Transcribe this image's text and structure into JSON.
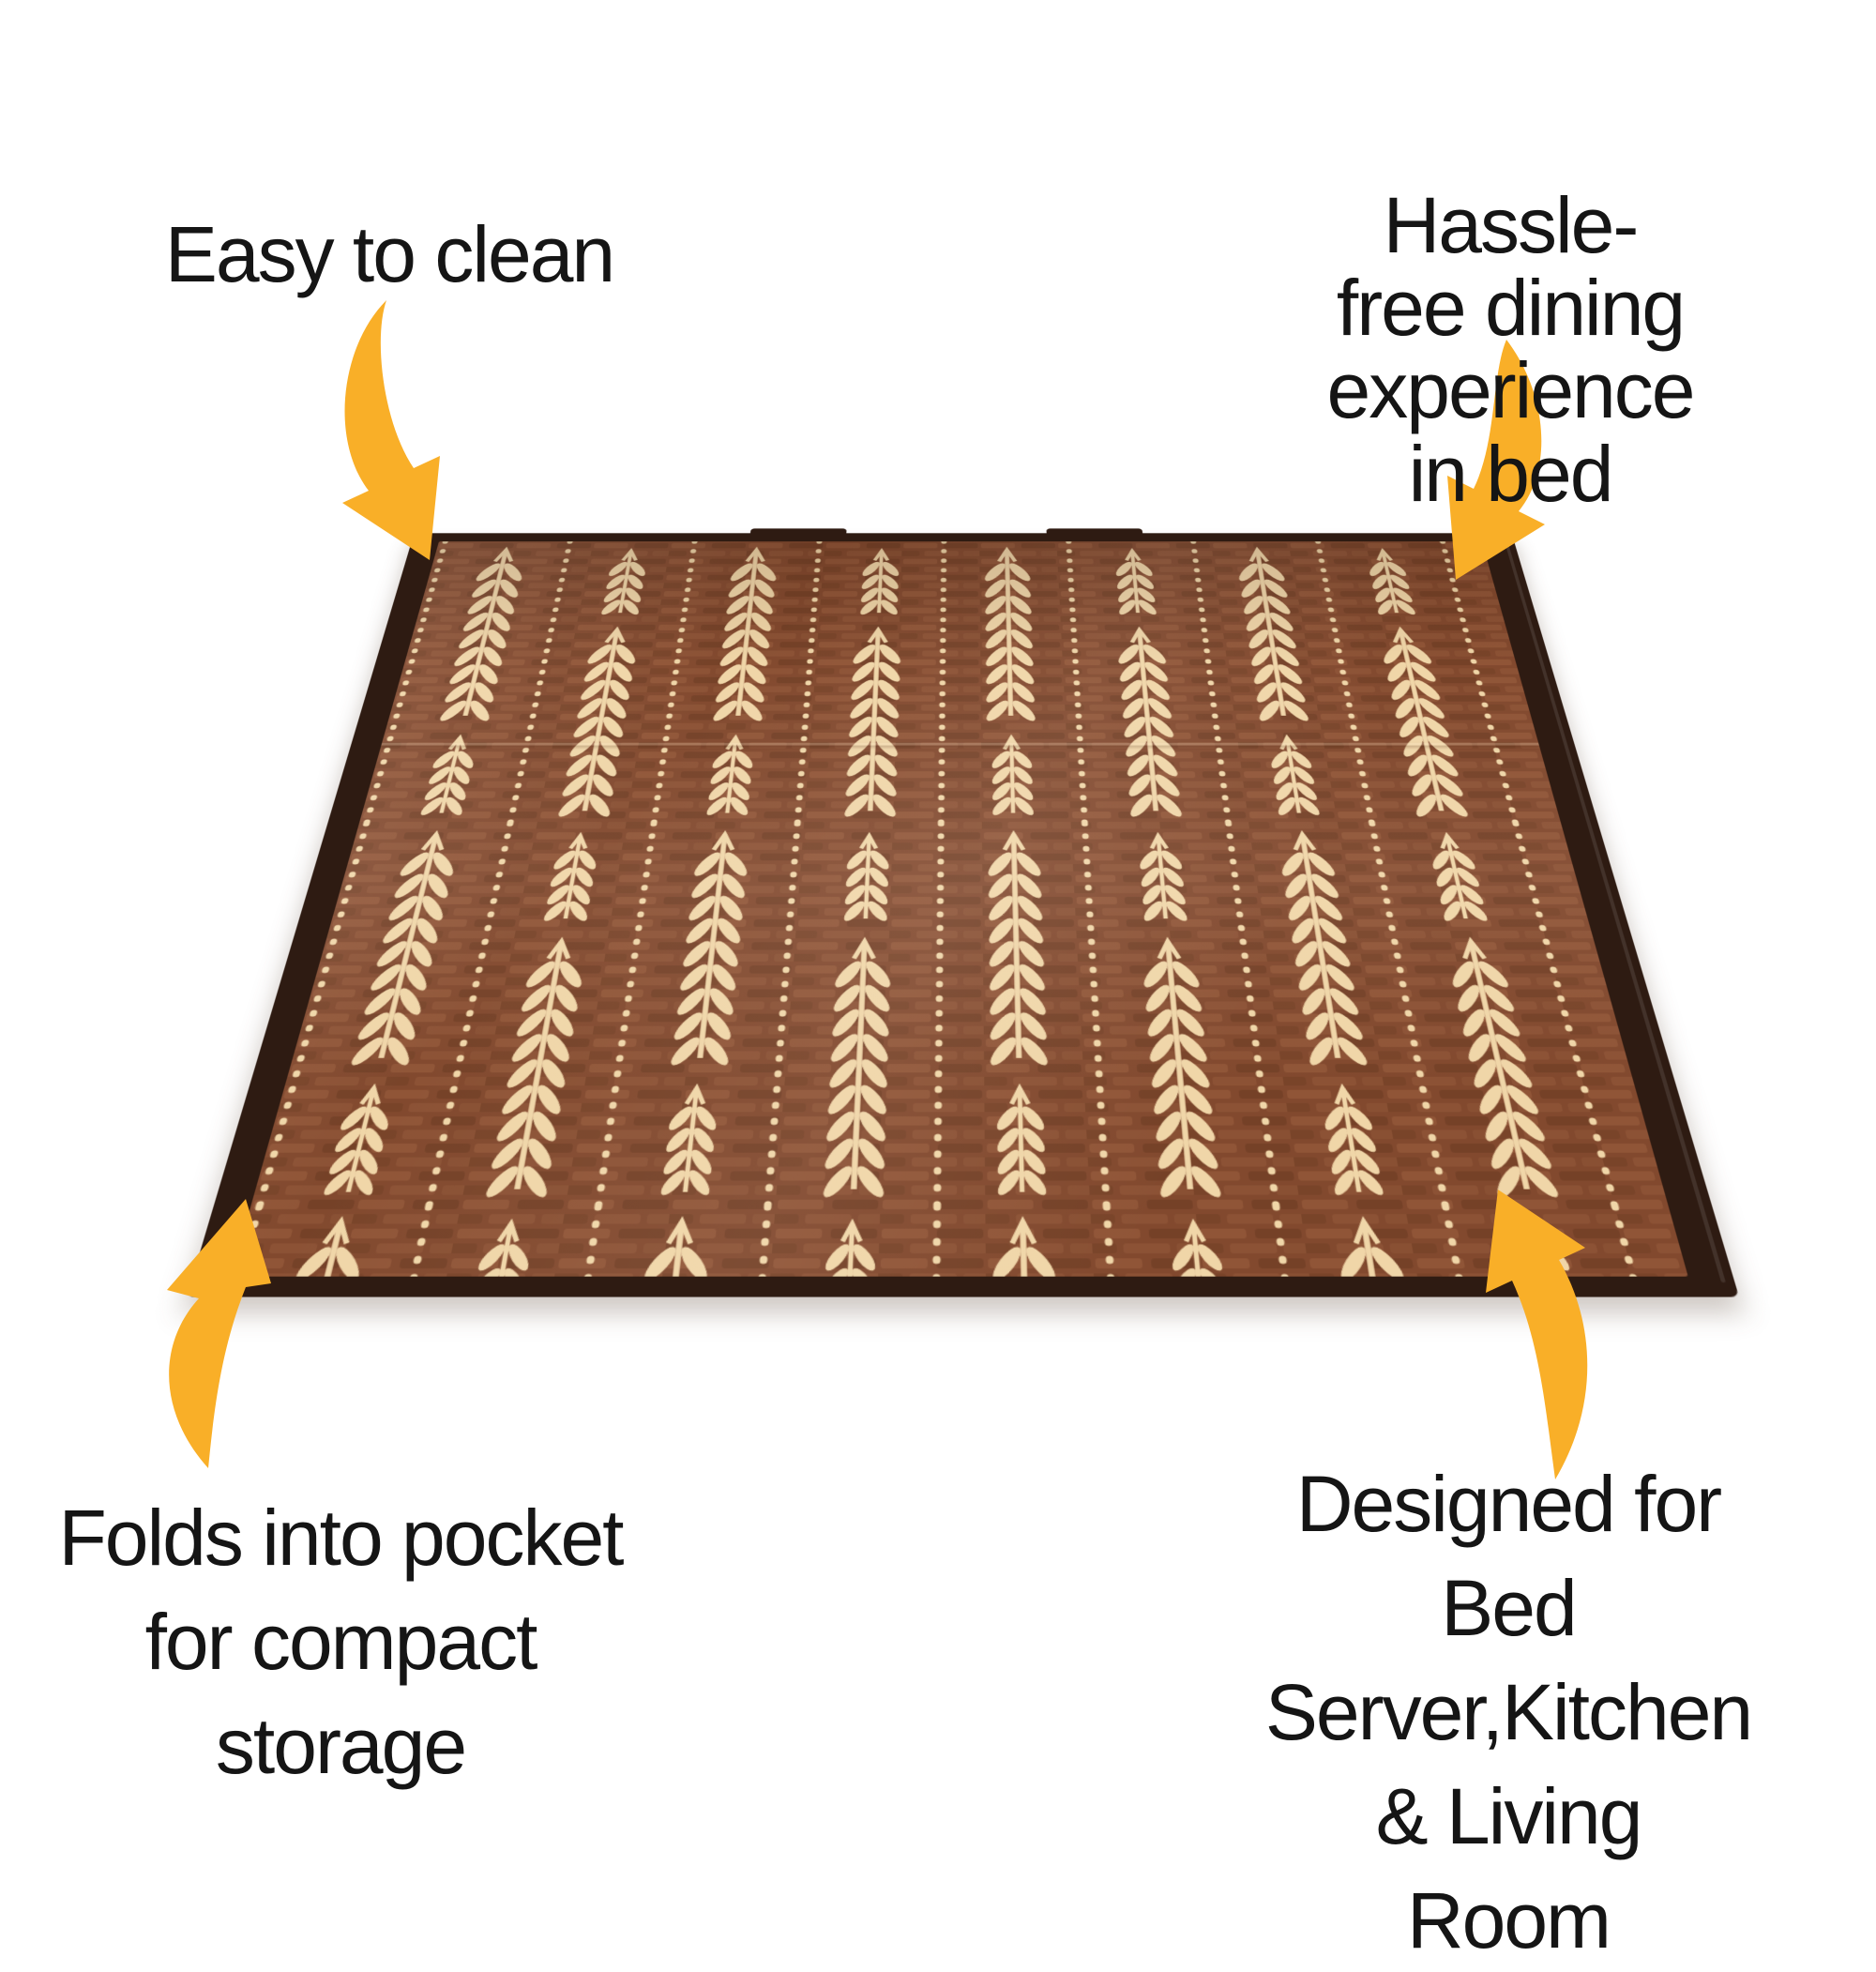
{
  "page": {
    "background": "#FFFFFF",
    "text_color": "#151515"
  },
  "callouts": {
    "top_left": "Easy to clean",
    "top_right": "Hassle-free dining\nexperience in bed",
    "bottom_left": "Folds into pocket\nfor compact\nstorage",
    "bottom_right": "Designed for\nBed Server,Kitchen\n& Living Room"
  },
  "arrows": {
    "color": "#F9AF28",
    "items": [
      {
        "name": "curved-arrow-top-left"
      },
      {
        "name": "curved-arrow-top-right"
      },
      {
        "name": "curved-arrow-bottom-left"
      },
      {
        "name": "curved-arrow-bottom-right"
      }
    ]
  },
  "mat": {
    "pattern_name": "wheat-sprig-print",
    "colors": {
      "base": "#82492E",
      "weave_light": "#9A5F3E",
      "weave_dark": "#66381F",
      "print_cream": "#F0D6A8",
      "binding": "#2E1B12"
    }
  }
}
